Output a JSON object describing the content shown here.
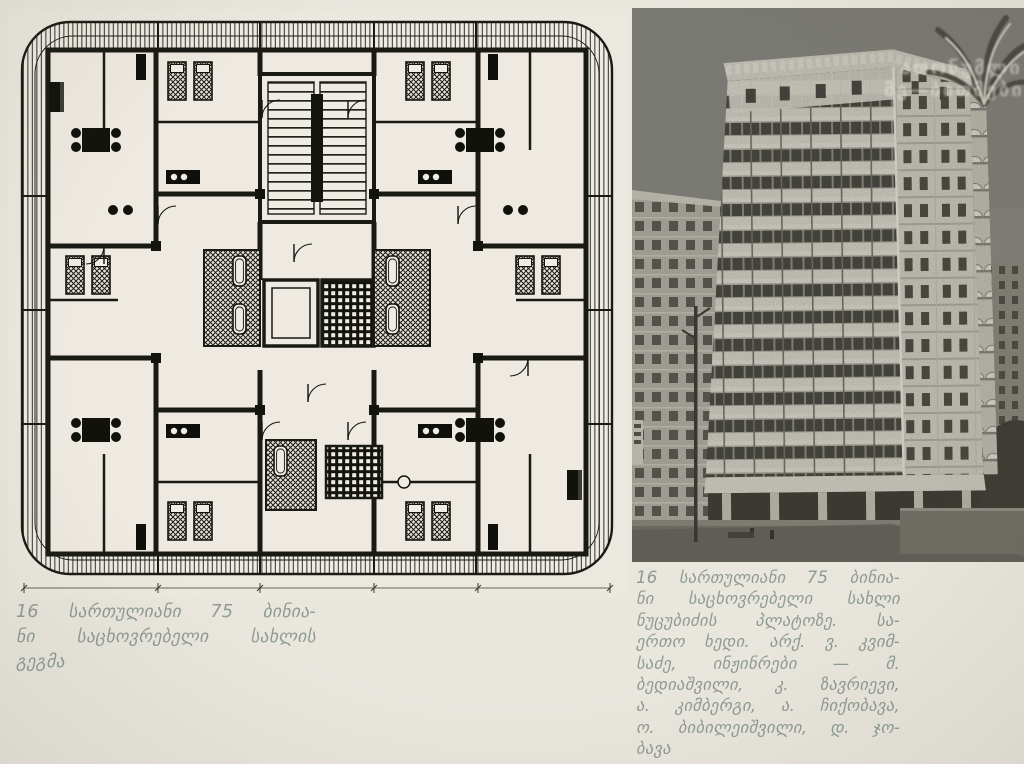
{
  "page": {
    "kind": "scanned book page with floor plan and photograph"
  },
  "captions": {
    "left_lines": [
      "16 სართულიანი 75 ბინია-",
      "ნი საცხოვრებელი სახლის",
      "გეგმა"
    ],
    "right_lines": [
      "16 სართულიანი 75 ბინია-",
      "ნი საცხოვრებელი სახლი",
      "ნუცუბიძის პლატოზე. სა-",
      "ერთო ხედი. არქ. ვ. კვიმ-",
      "საძე, ინჟინრები — მ.",
      "ბედიაშვილი, კ. ზავრიევი,",
      "ა. კიმბერგი, ა. ჩიქობავა,",
      "ო. ბიბილეიშვილი, დ. ჯო-",
      "ბავა"
    ]
  },
  "watermark": {
    "line1": "ათონუმლი",
    "line2": "მე—ბითმები"
  },
  "colors": {
    "paper": "#e9e6de",
    "caption_ink": "#8e9b92",
    "plan_ink": "#1a1a15",
    "photo_sky": "#8c8b84",
    "building_white": "#e7e4da",
    "window_dark": "#3a3934"
  }
}
